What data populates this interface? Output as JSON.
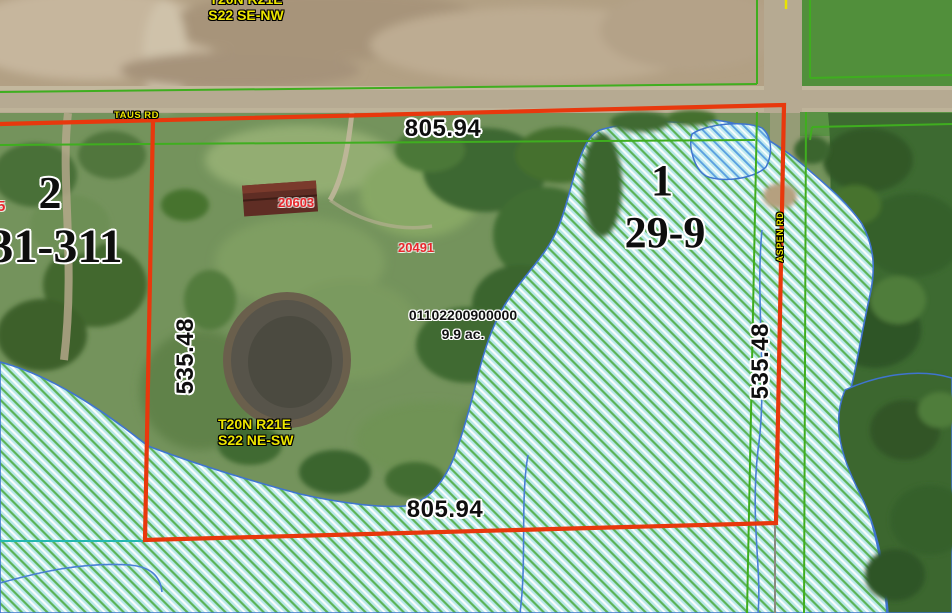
{
  "map": {
    "region_top": {
      "township": "T20N R21E",
      "section": "S22 SE-NW"
    },
    "region_mid": {
      "township": "T20N R21E",
      "section": "S22 NE-SW"
    },
    "roads": {
      "horizontal": "TAUS RD",
      "vertical": "ASPEN RD"
    },
    "parcel": {
      "id": "01102200900000",
      "area": "9.9 ac.",
      "section_number": "1",
      "plat_number": "29-9",
      "dim_top": "805.94",
      "dim_bottom": "805.94",
      "dim_left": "535.48",
      "dim_right": "535.48",
      "address_north": "20603",
      "address_central": "20491"
    },
    "adjacent_parcel": {
      "section_number": "2",
      "plat_number": "31-311",
      "partial_red_label": "5"
    },
    "colors": {
      "parcel_boundary_red": "#e8380d",
      "label_yellow": "#ede600",
      "address_red": "#e8262c",
      "wetland_fill_cyan": "#b9e8ea",
      "wetland_hatch_green": "#57b04e",
      "wetland_hatch_blue": "#5aa0e0",
      "wetland_edge_blue": "#3f74cf",
      "section_line_green": "#3fae1f",
      "stream_blue": "#4a7fd4",
      "tie_line_teal": "#25b8b0"
    }
  }
}
